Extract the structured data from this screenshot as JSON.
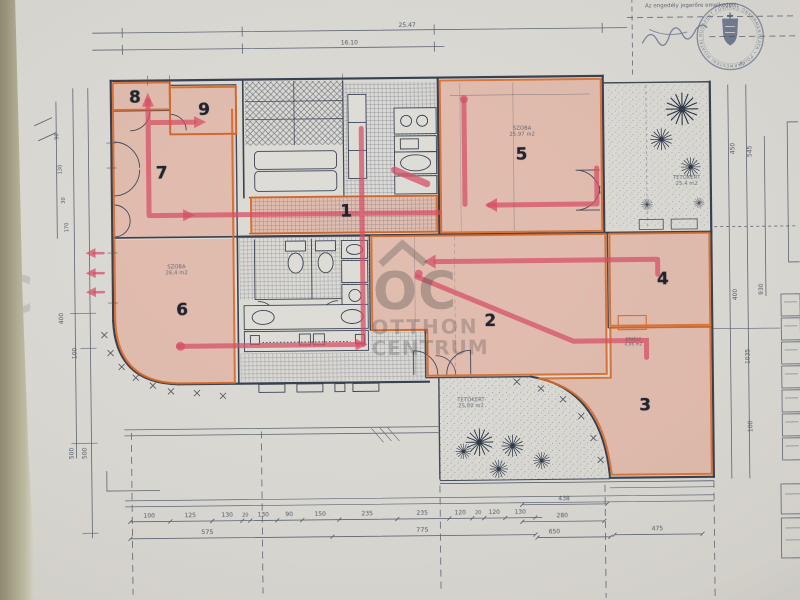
{
  "rooms": {
    "r1": "1",
    "r2": "2",
    "r3": "3",
    "r4": "4",
    "r5": "5",
    "r6": "6",
    "r7": "7",
    "r8": "8",
    "r9": "9"
  },
  "watermark": {
    "oc": "OC",
    "line1": "OTTHON",
    "line2": "CENTRUM"
  },
  "stamp": {
    "top_text": "Az engedély jogerőre emelkedett:",
    "seal_text": "BUDAPEST FŐVÁROS ÖNKORMÁNYZATA • POLGÁRMESTERI HIVATAL •",
    "number": "87."
  },
  "notes": {
    "terrace_top": {
      "title": "TETŐKERT",
      "area": "25,4 m2"
    },
    "terrace_bottom": {
      "title": "TETŐKERT",
      "area": "25,80 m2"
    },
    "room5": {
      "title": "SZOBA",
      "area": "25,97 m2"
    },
    "room6": {
      "title": "SZOBA",
      "area": "26,4 m2"
    },
    "room3": {
      "title": "ERKÉLY",
      "area": "4,06 m2"
    }
  },
  "dims": {
    "top": [
      "25.47",
      "16.10"
    ],
    "bottom": [
      "100",
      "125",
      "130",
      "20",
      "130",
      "90",
      "150",
      "235",
      "235",
      "120",
      "20",
      "120",
      "130"
    ],
    "bottom2": [
      "575",
      "775"
    ],
    "right_lower": [
      "438",
      "280",
      "650",
      "475"
    ],
    "left": [
      "400",
      "100",
      "500",
      "500",
      "90",
      "130",
      "30",
      "170"
    ],
    "right": [
      "450",
      "545",
      "400",
      "930",
      "1035",
      "100"
    ]
  }
}
